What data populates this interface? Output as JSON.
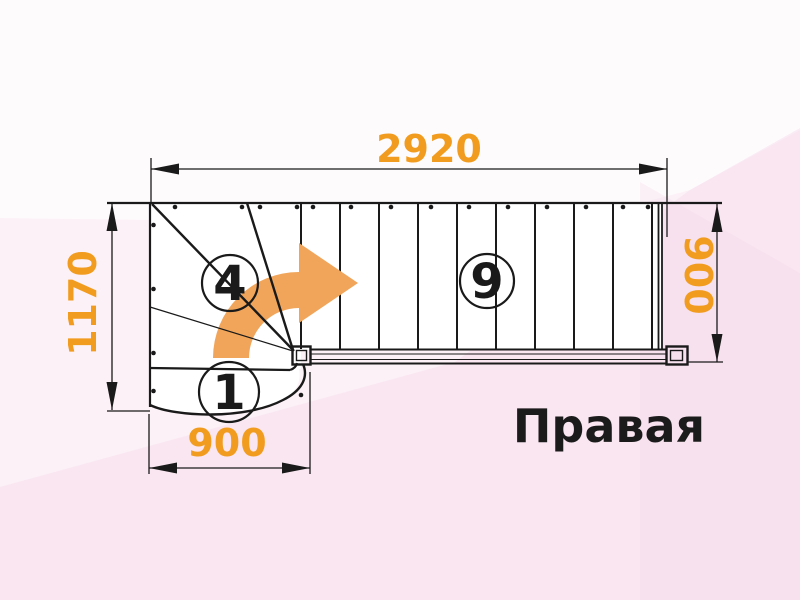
{
  "title": "Правая",
  "drawing": {
    "dimensions": {
      "top": "2920",
      "left": "1170",
      "bottom": "900",
      "right": "900"
    },
    "step_labels": {
      "first_step": "1",
      "winder_last_step": "4",
      "flight_step": "9"
    }
  },
  "colors": {
    "dimension_text": "#F29C1F",
    "direction_arrow": "#F0A55A",
    "drawing_lines": "#1A1A1A",
    "background": "#FCF1F7"
  }
}
